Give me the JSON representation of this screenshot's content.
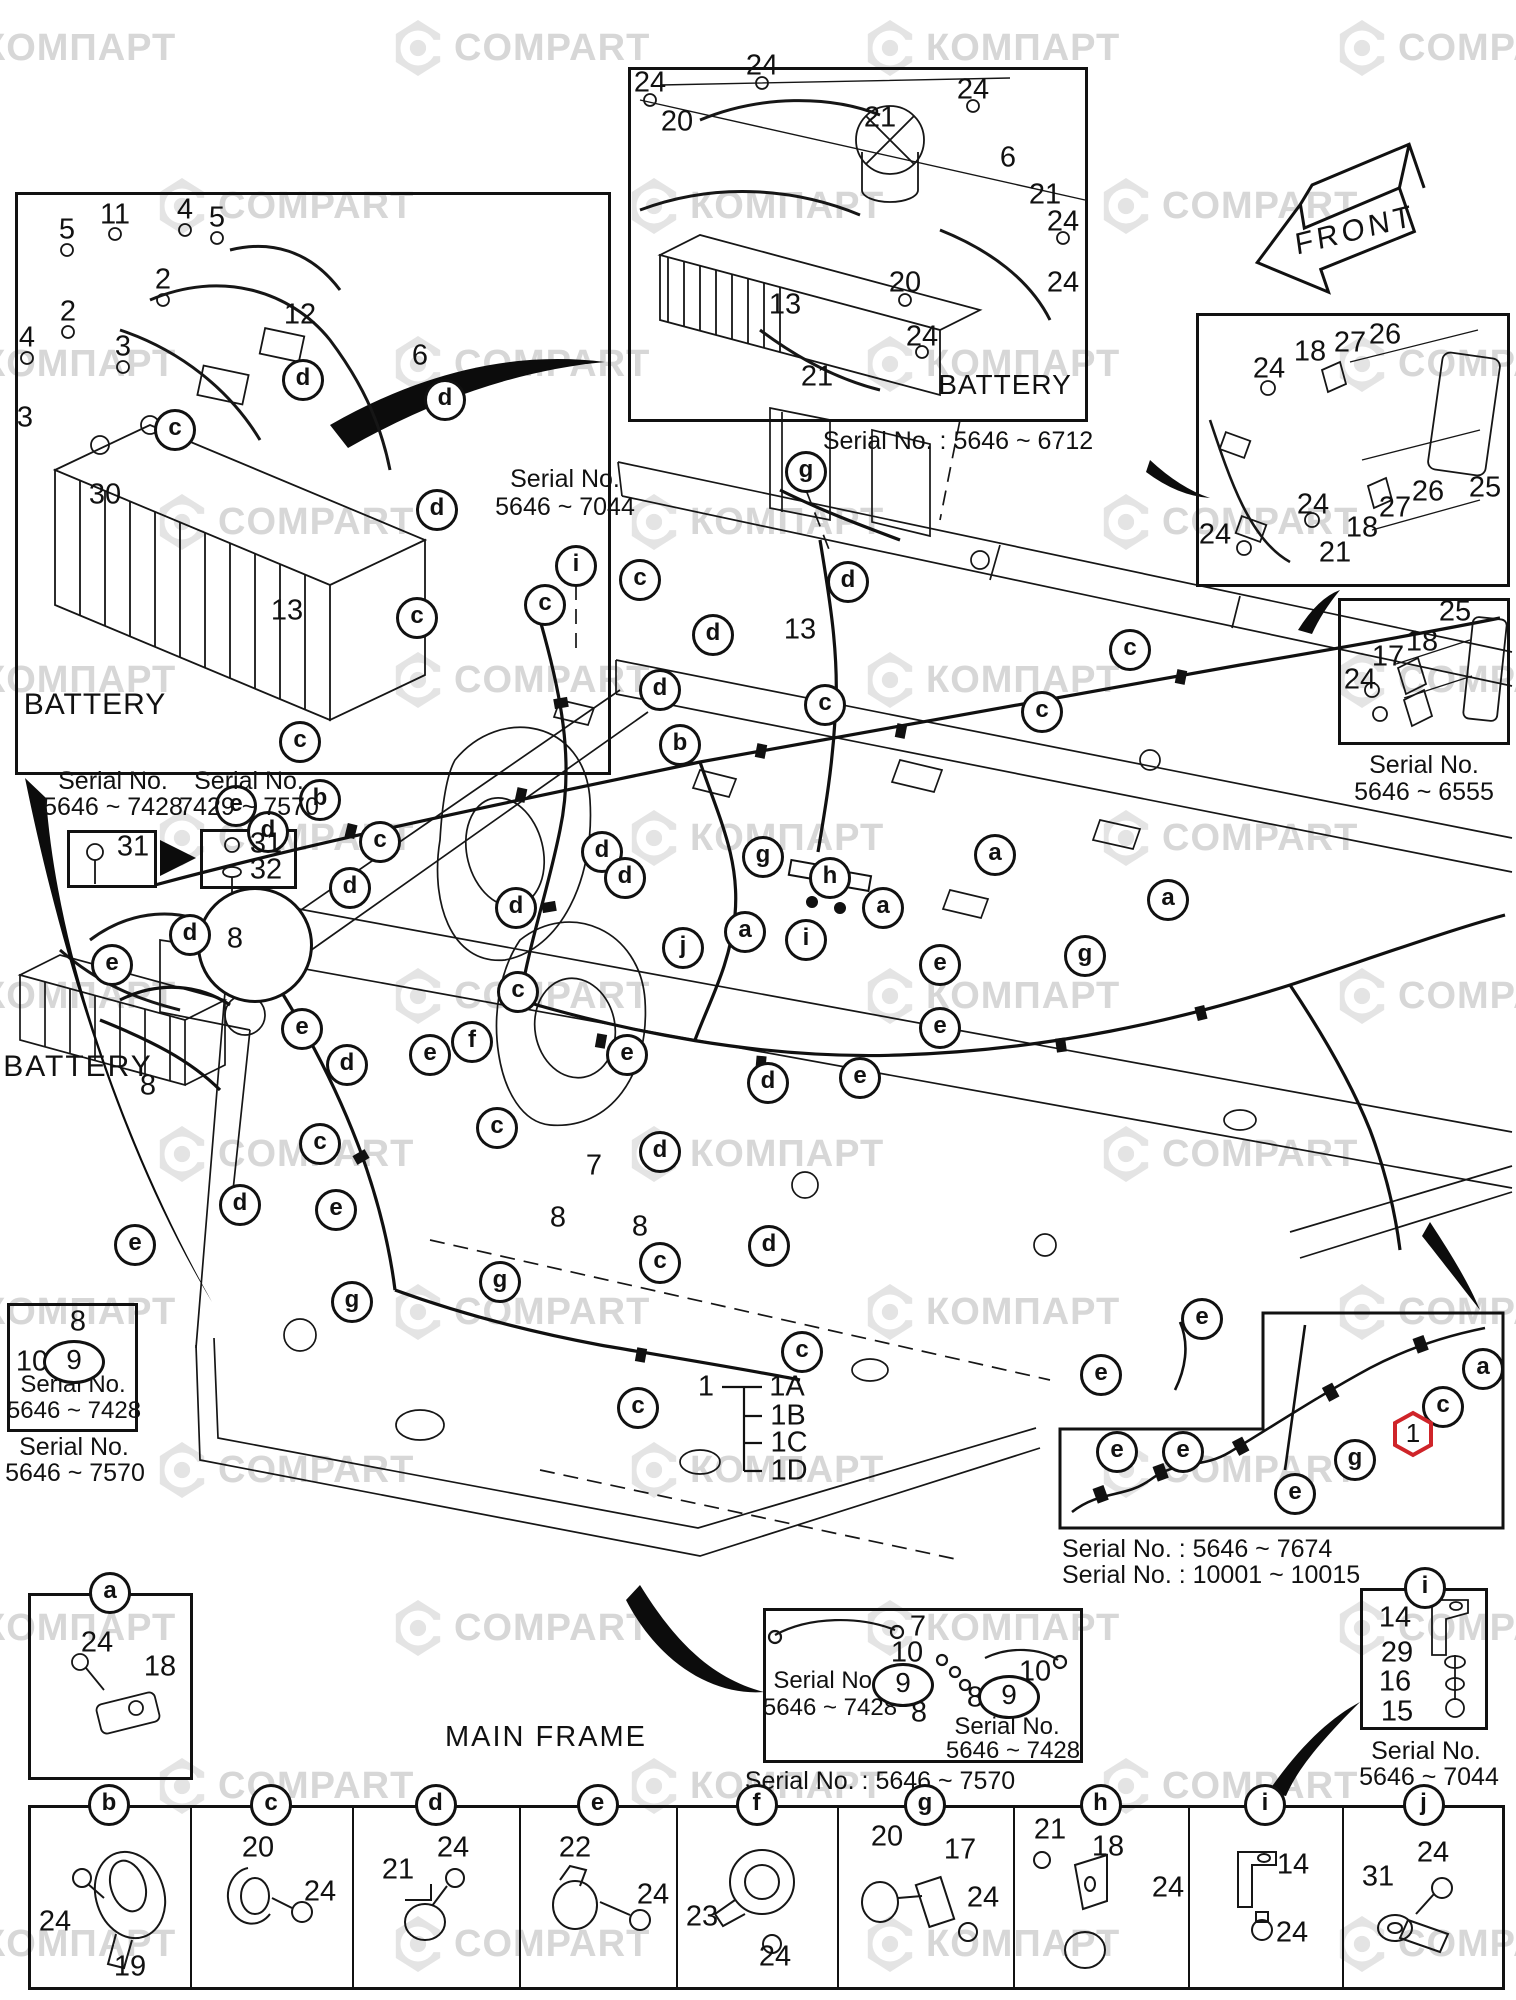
{
  "page": {
    "width": 1516,
    "height": 2000,
    "kind": "parts-catalog exploded wiring diagram"
  },
  "watermark": {
    "texts": [
      "КОМПАРТ",
      "COMPART"
    ],
    "text_color": "#d7d7d7",
    "logo_color": "#e4e4e4"
  },
  "front_arrow": {
    "label": "FRONT"
  },
  "main": {
    "texts": [
      {
        "t": "BATTERY",
        "x": 78,
        "y": 1050,
        "size": 30,
        "ls": 2,
        "name": "battery-mid-left-label"
      },
      {
        "t": "MAIN FRAME",
        "x": 546,
        "y": 1722,
        "size": 29,
        "ls": 2,
        "name": "main-frame-label"
      },
      {
        "t": "Serial No.",
        "x": 565,
        "y": 466,
        "size": 25,
        "name": "serial-note-7044"
      },
      {
        "t": "5646 ~ 7044",
        "x": 565,
        "y": 494,
        "size": 25,
        "name": "serial-note-7044"
      }
    ],
    "numbers": [
      {
        "n": "13",
        "x": 800,
        "y": 630
      },
      {
        "n": "8",
        "x": 148,
        "y": 1086
      },
      {
        "n": "7",
        "x": 594,
        "y": 1166
      },
      {
        "n": "8",
        "x": 558,
        "y": 1218
      },
      {
        "n": "8",
        "x": 640,
        "y": 1227
      }
    ],
    "letters": [
      {
        "l": "g",
        "x": 806,
        "y": 472
      },
      {
        "l": "i",
        "x": 576,
        "y": 566
      },
      {
        "l": "c",
        "x": 640,
        "y": 580
      },
      {
        "l": "c",
        "x": 545,
        "y": 605
      },
      {
        "l": "c",
        "x": 417,
        "y": 618
      },
      {
        "l": "d",
        "x": 713,
        "y": 635
      },
      {
        "l": "d",
        "x": 848,
        "y": 582
      },
      {
        "l": "c",
        "x": 1130,
        "y": 650
      },
      {
        "l": "c",
        "x": 825,
        "y": 705
      },
      {
        "l": "d",
        "x": 660,
        "y": 690
      },
      {
        "l": "c",
        "x": 1042,
        "y": 712
      },
      {
        "l": "b",
        "x": 680,
        "y": 745
      },
      {
        "l": "c",
        "x": 300,
        "y": 742
      },
      {
        "l": "b",
        "x": 320,
        "y": 800
      },
      {
        "l": "e",
        "x": 236,
        "y": 806
      },
      {
        "l": "d",
        "x": 268,
        "y": 832
      },
      {
        "l": "c",
        "x": 380,
        "y": 842
      },
      {
        "l": "d",
        "x": 602,
        "y": 852
      },
      {
        "l": "d",
        "x": 625,
        "y": 878
      },
      {
        "l": "d",
        "x": 350,
        "y": 888
      },
      {
        "l": "d",
        "x": 516,
        "y": 908
      },
      {
        "l": "g",
        "x": 763,
        "y": 857
      },
      {
        "l": "h",
        "x": 830,
        "y": 878
      },
      {
        "l": "a",
        "x": 995,
        "y": 855
      },
      {
        "l": "a",
        "x": 883,
        "y": 908
      },
      {
        "l": "i",
        "x": 806,
        "y": 940
      },
      {
        "l": "a",
        "x": 745,
        "y": 932
      },
      {
        "l": "j",
        "x": 683,
        "y": 948
      },
      {
        "l": "e",
        "x": 940,
        "y": 965
      },
      {
        "l": "g",
        "x": 1085,
        "y": 956
      },
      {
        "l": "a",
        "x": 1168,
        "y": 900
      },
      {
        "l": "d",
        "x": 190,
        "y": 935
      },
      {
        "l": "e",
        "x": 112,
        "y": 965
      },
      {
        "l": "c",
        "x": 518,
        "y": 992
      },
      {
        "l": "e",
        "x": 302,
        "y": 1029
      },
      {
        "l": "e",
        "x": 940,
        "y": 1028
      },
      {
        "l": "f",
        "x": 472,
        "y": 1042
      },
      {
        "l": "e",
        "x": 430,
        "y": 1055
      },
      {
        "l": "e",
        "x": 627,
        "y": 1055
      },
      {
        "l": "d",
        "x": 347,
        "y": 1065
      },
      {
        "l": "d",
        "x": 768,
        "y": 1083
      },
      {
        "l": "e",
        "x": 860,
        "y": 1078
      },
      {
        "l": "c",
        "x": 497,
        "y": 1128
      },
      {
        "l": "c",
        "x": 320,
        "y": 1144
      },
      {
        "l": "d",
        "x": 660,
        "y": 1152
      },
      {
        "l": "d",
        "x": 240,
        "y": 1205
      },
      {
        "l": "e",
        "x": 336,
        "y": 1210
      },
      {
        "l": "e",
        "x": 135,
        "y": 1245
      },
      {
        "l": "d",
        "x": 769,
        "y": 1246
      },
      {
        "l": "c",
        "x": 660,
        "y": 1263
      },
      {
        "l": "g",
        "x": 352,
        "y": 1302
      },
      {
        "l": "g",
        "x": 500,
        "y": 1282
      },
      {
        "l": "c",
        "x": 802,
        "y": 1352
      },
      {
        "l": "c",
        "x": 638,
        "y": 1408
      },
      {
        "l": "e",
        "x": 1202,
        "y": 1319
      },
      {
        "l": "e",
        "x": 1101,
        "y": 1375
      }
    ],
    "legend": {
      "number": "1",
      "x": 706,
      "y": 1387,
      "items": [
        {
          "t": "1A",
          "x": 787,
          "y": 1387
        },
        {
          "t": "1B",
          "x": 788,
          "y": 1416
        },
        {
          "t": "1C",
          "x": 789,
          "y": 1443
        },
        {
          "t": "1D",
          "x": 789,
          "y": 1471
        }
      ]
    },
    "magnifier": {
      "n": "8",
      "x": 255,
      "y": 945,
      "r": 58
    },
    "serial_boxes": [
      {
        "captions": [
          {
            "t": "Serial No.",
            "x": 113,
            "y": 768,
            "size": 25
          },
          {
            "t": "5646 ~ 7428",
            "x": 113,
            "y": 794,
            "size": 25
          }
        ],
        "box": [
          67,
          830,
          90,
          58
        ],
        "numbers": [
          {
            "n": "31",
            "x": 133,
            "y": 847
          }
        ]
      },
      {
        "captions": [
          {
            "t": "Serial No.",
            "x": 249,
            "y": 768,
            "size": 25
          },
          {
            "t": "7429 ~ 7570",
            "x": 249,
            "y": 794,
            "size": 25
          }
        ],
        "box": [
          200,
          829,
          97,
          60
        ],
        "numbers": [
          {
            "n": "31",
            "x": 266,
            "y": 844
          },
          {
            "n": "32",
            "x": 266,
            "y": 870
          }
        ]
      }
    ]
  },
  "insets": [
    {
      "id": "battery-upper-left",
      "box": [
        15,
        192,
        596,
        583
      ],
      "captions": [
        {
          "t": "BATTERY",
          "x": 95,
          "y": 688,
          "size": 30,
          "ls": 1
        }
      ],
      "numbers": [
        {
          "n": "5",
          "x": 67,
          "y": 230
        },
        {
          "n": "11",
          "x": 115,
          "y": 215
        },
        {
          "n": "4",
          "x": 185,
          "y": 210
        },
        {
          "n": "5",
          "x": 217,
          "y": 218
        },
        {
          "n": "2",
          "x": 163,
          "y": 280
        },
        {
          "n": "2",
          "x": 68,
          "y": 312
        },
        {
          "n": "3",
          "x": 123,
          "y": 347
        },
        {
          "n": "4",
          "x": 27,
          "y": 338
        },
        {
          "n": "12",
          "x": 300,
          "y": 315
        },
        {
          "n": "3",
          "x": 25,
          "y": 418
        },
        {
          "n": "30",
          "x": 105,
          "y": 495
        },
        {
          "n": "13",
          "x": 287,
          "y": 611
        },
        {
          "n": "6",
          "x": 420,
          "y": 356
        }
      ],
      "letters": [
        {
          "l": "c",
          "x": 175,
          "y": 430
        },
        {
          "l": "d",
          "x": 303,
          "y": 380
        },
        {
          "l": "d",
          "x": 445,
          "y": 400
        },
        {
          "l": "d",
          "x": 437,
          "y": 510
        }
      ]
    },
    {
      "id": "battery-upper-center",
      "box": [
        628,
        67,
        460,
        355
      ],
      "captions": [
        {
          "t": "BATTERY",
          "x": 1005,
          "y": 370,
          "size": 28,
          "ls": 1
        },
        {
          "t": "Serial No. : 5646 ~ 6712",
          "x": 958,
          "y": 428,
          "size": 25
        }
      ],
      "numbers": [
        {
          "n": "24",
          "x": 650,
          "y": 83
        },
        {
          "n": "20",
          "x": 677,
          "y": 122
        },
        {
          "n": "24",
          "x": 762,
          "y": 66
        },
        {
          "n": "21",
          "x": 880,
          "y": 118
        },
        {
          "n": "24",
          "x": 973,
          "y": 90
        },
        {
          "n": "6",
          "x": 1008,
          "y": 158
        },
        {
          "n": "21",
          "x": 1045,
          "y": 195
        },
        {
          "n": "24",
          "x": 1063,
          "y": 222
        },
        {
          "n": "20",
          "x": 905,
          "y": 283
        },
        {
          "n": "24",
          "x": 1063,
          "y": 283
        },
        {
          "n": "13",
          "x": 785,
          "y": 305
        },
        {
          "n": "24",
          "x": 922,
          "y": 337
        },
        {
          "n": "21",
          "x": 817,
          "y": 377
        }
      ],
      "letters": []
    },
    {
      "id": "bracket-upper-right",
      "box": [
        1196,
        313,
        314,
        274
      ],
      "captions": [],
      "numbers": [
        {
          "n": "24",
          "x": 1269,
          "y": 369
        },
        {
          "n": "18",
          "x": 1310,
          "y": 352
        },
        {
          "n": "27",
          "x": 1350,
          "y": 343
        },
        {
          "n": "26",
          "x": 1385,
          "y": 335
        },
        {
          "n": "25",
          "x": 1485,
          "y": 488
        },
        {
          "n": "24",
          "x": 1215,
          "y": 535
        },
        {
          "n": "18",
          "x": 1362,
          "y": 528
        },
        {
          "n": "27",
          "x": 1395,
          "y": 508
        },
        {
          "n": "26",
          "x": 1428,
          "y": 492
        },
        {
          "n": "24",
          "x": 1313,
          "y": 505
        },
        {
          "n": "21",
          "x": 1335,
          "y": 553
        }
      ],
      "letters": []
    },
    {
      "id": "bracket-right",
      "box": [
        1338,
        598,
        172,
        147
      ],
      "captions": [
        {
          "t": "Serial No.",
          "x": 1424,
          "y": 752,
          "size": 25
        },
        {
          "t": "5646 ~ 6555",
          "x": 1424,
          "y": 779,
          "size": 25
        }
      ],
      "numbers": [
        {
          "n": "25",
          "x": 1455,
          "y": 612
        },
        {
          "n": "18",
          "x": 1422,
          "y": 642
        },
        {
          "n": "17",
          "x": 1388,
          "y": 657
        },
        {
          "n": "24",
          "x": 1360,
          "y": 680
        }
      ],
      "letters": []
    },
    {
      "id": "serial-8-10-9",
      "box": [
        7,
        1303,
        131,
        129
      ],
      "captions": [
        {
          "t": "Serial No.",
          "x": 73,
          "y": 1372,
          "size": 24
        },
        {
          "t": "5646 ~ 7428",
          "x": 74,
          "y": 1398,
          "size": 24
        },
        {
          "t": "Serial No.",
          "x": 74,
          "y": 1434,
          "size": 25
        },
        {
          "t": "5646 ~ 7570",
          "x": 75,
          "y": 1460,
          "size": 25
        }
      ],
      "numbers": [
        {
          "n": "8",
          "x": 78,
          "y": 1322
        },
        {
          "n": "10",
          "x": 32,
          "y": 1362
        }
      ],
      "ovals": [
        {
          "n": "9",
          "x": 74,
          "y": 1362
        }
      ],
      "letters": []
    },
    {
      "id": "clamp-a",
      "box": [
        28,
        1593,
        165,
        187
      ],
      "captions": [],
      "numbers": [
        {
          "n": "24",
          "x": 97,
          "y": 1643
        },
        {
          "n": "18",
          "x": 160,
          "y": 1667
        }
      ],
      "letters": [
        {
          "l": "a",
          "x": 110,
          "y": 1593
        }
      ]
    },
    {
      "id": "harness-bottom-center",
      "box": [
        763,
        1608,
        320,
        155
      ],
      "captions": [
        {
          "t": "Serial No.",
          "x": 826,
          "y": 1668,
          "size": 24
        },
        {
          "t": "5646 ~ 7428",
          "x": 830,
          "y": 1695,
          "size": 24
        },
        {
          "t": "Serial No.",
          "x": 1007,
          "y": 1714,
          "size": 24
        },
        {
          "t": "5646 ~ 7428",
          "x": 1013,
          "y": 1738,
          "size": 24
        },
        {
          "t": "Serial No. : 5646 ~ 7570",
          "x": 880,
          "y": 1768,
          "size": 25
        }
      ],
      "numbers": [
        {
          "n": "7",
          "x": 918,
          "y": 1627
        },
        {
          "n": "10",
          "x": 907,
          "y": 1653
        },
        {
          "n": "8",
          "x": 919,
          "y": 1713
        },
        {
          "n": "10",
          "x": 1035,
          "y": 1672
        },
        {
          "n": "8",
          "x": 975,
          "y": 1698
        }
      ],
      "ovals": [
        {
          "n": "9",
          "x": 903,
          "y": 1685
        },
        {
          "n": "9",
          "x": 1009,
          "y": 1697
        }
      ],
      "letters": []
    },
    {
      "id": "harness-bottom-right",
      "poly": true,
      "captions": [
        {
          "t": "Serial No. : 5646 ~ 7674",
          "x": 1062,
          "y": 1536,
          "size": 25,
          "left": true
        },
        {
          "t": "Serial No. : 10001 ~ 10015",
          "x": 1062,
          "y": 1562,
          "size": 25,
          "left": true
        }
      ],
      "numbers": [],
      "letters": [
        {
          "l": "e",
          "x": 1117,
          "y": 1452
        },
        {
          "l": "e",
          "x": 1183,
          "y": 1452
        },
        {
          "l": "e",
          "x": 1295,
          "y": 1494
        },
        {
          "l": "g",
          "x": 1355,
          "y": 1460
        },
        {
          "l": "c",
          "x": 1443,
          "y": 1407
        },
        {
          "l": "a",
          "x": 1483,
          "y": 1369
        }
      ],
      "hex": {
        "n": "1",
        "x": 1413,
        "y": 1434,
        "color": "#cf2429"
      }
    },
    {
      "id": "bracket-i",
      "box": [
        1360,
        1588,
        128,
        142
      ],
      "captions": [
        {
          "t": "Serial No.",
          "x": 1426,
          "y": 1738,
          "size": 25
        },
        {
          "t": "5646 ~ 7044",
          "x": 1429,
          "y": 1764,
          "size": 25
        }
      ],
      "numbers": [
        {
          "n": "14",
          "x": 1395,
          "y": 1618
        },
        {
          "n": "29",
          "x": 1397,
          "y": 1653
        },
        {
          "n": "16",
          "x": 1395,
          "y": 1682
        },
        {
          "n": "15",
          "x": 1397,
          "y": 1712
        }
      ],
      "letters": [
        {
          "l": "i",
          "x": 1425,
          "y": 1588
        }
      ]
    }
  ],
  "parts_table": {
    "y": 1805,
    "h": 185,
    "boundaries": [
      28,
      190,
      352,
      519,
      676,
      837,
      1013,
      1188,
      1342,
      1505
    ],
    "cells": [
      {
        "letter": "b",
        "numbers": [
          {
            "n": "24",
            "x": 55,
            "y": 1922
          },
          {
            "n": "19",
            "x": 130,
            "y": 1967
          }
        ]
      },
      {
        "letter": "c",
        "numbers": [
          {
            "n": "20",
            "x": 258,
            "y": 1848
          },
          {
            "n": "24",
            "x": 320,
            "y": 1892
          }
        ]
      },
      {
        "letter": "d",
        "numbers": [
          {
            "n": "21",
            "x": 398,
            "y": 1870
          },
          {
            "n": "24",
            "x": 453,
            "y": 1848
          }
        ]
      },
      {
        "letter": "e",
        "numbers": [
          {
            "n": "22",
            "x": 575,
            "y": 1848
          },
          {
            "n": "24",
            "x": 653,
            "y": 1895
          }
        ]
      },
      {
        "letter": "f",
        "numbers": [
          {
            "n": "23",
            "x": 702,
            "y": 1917
          },
          {
            "n": "24",
            "x": 775,
            "y": 1957
          }
        ]
      },
      {
        "letter": "g",
        "numbers": [
          {
            "n": "20",
            "x": 887,
            "y": 1837
          },
          {
            "n": "17",
            "x": 960,
            "y": 1850
          },
          {
            "n": "24",
            "x": 983,
            "y": 1898
          }
        ]
      },
      {
        "letter": "h",
        "numbers": [
          {
            "n": "21",
            "x": 1050,
            "y": 1830
          },
          {
            "n": "18",
            "x": 1108,
            "y": 1847
          },
          {
            "n": "24",
            "x": 1168,
            "y": 1888
          }
        ]
      },
      {
        "letter": "i",
        "numbers": [
          {
            "n": "14",
            "x": 1293,
            "y": 1865
          },
          {
            "n": "24",
            "x": 1292,
            "y": 1933
          }
        ]
      },
      {
        "letter": "j",
        "numbers": [
          {
            "n": "31",
            "x": 1378,
            "y": 1877
          },
          {
            "n": "24",
            "x": 1433,
            "y": 1853
          }
        ]
      }
    ]
  }
}
